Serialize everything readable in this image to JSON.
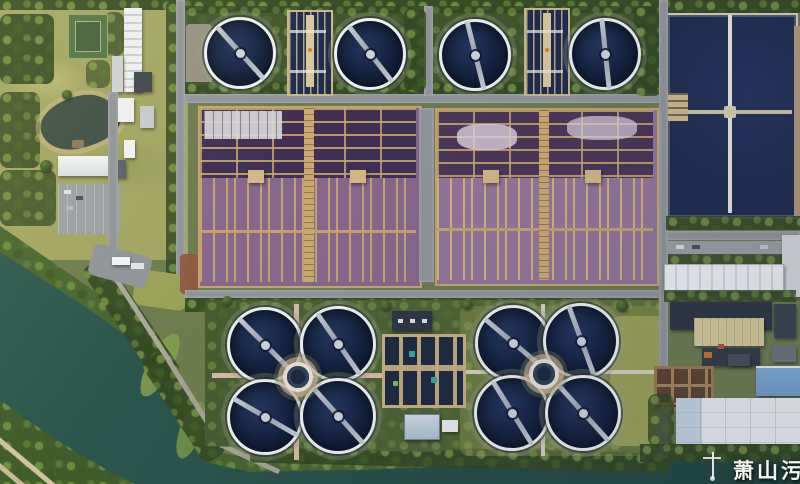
{
  "scene": {
    "type": "aerial-photograph",
    "subject": "wastewater-treatment-plant",
    "watermark": {
      "text": "萧山污水"
    }
  },
  "palette": {
    "river": "#2d5a50",
    "river_deep": "#1f453e",
    "clarifier_water": "#13213c",
    "clarifier_rim": "#ecf0f3",
    "bridge_gray": "#c3cbd3",
    "basin_navy": "#1d2c4e",
    "aeration_purple_left": "#87688d",
    "aeration_purple_right": "#93759a",
    "aeration_top_dark": "#412f54",
    "lane_tan": "#c5a46c",
    "tree_green": "#3c5629",
    "lawn_olive": "#a2a562",
    "road_gray": "#8f9499",
    "roof_white": "#edeff1",
    "roof_dark": "#2e3742",
    "roof_blue": "#6f9ec9",
    "roof_tan": "#d8cc96",
    "path_pink": "#d9b9a4",
    "soil_tan": "#b2987a",
    "bank_green": "#47662f",
    "grass_yellow": "#9aa158",
    "pond_water": "#3e4f44",
    "court_green": "#527544",
    "watermark_color": "#f5f5f0"
  }
}
